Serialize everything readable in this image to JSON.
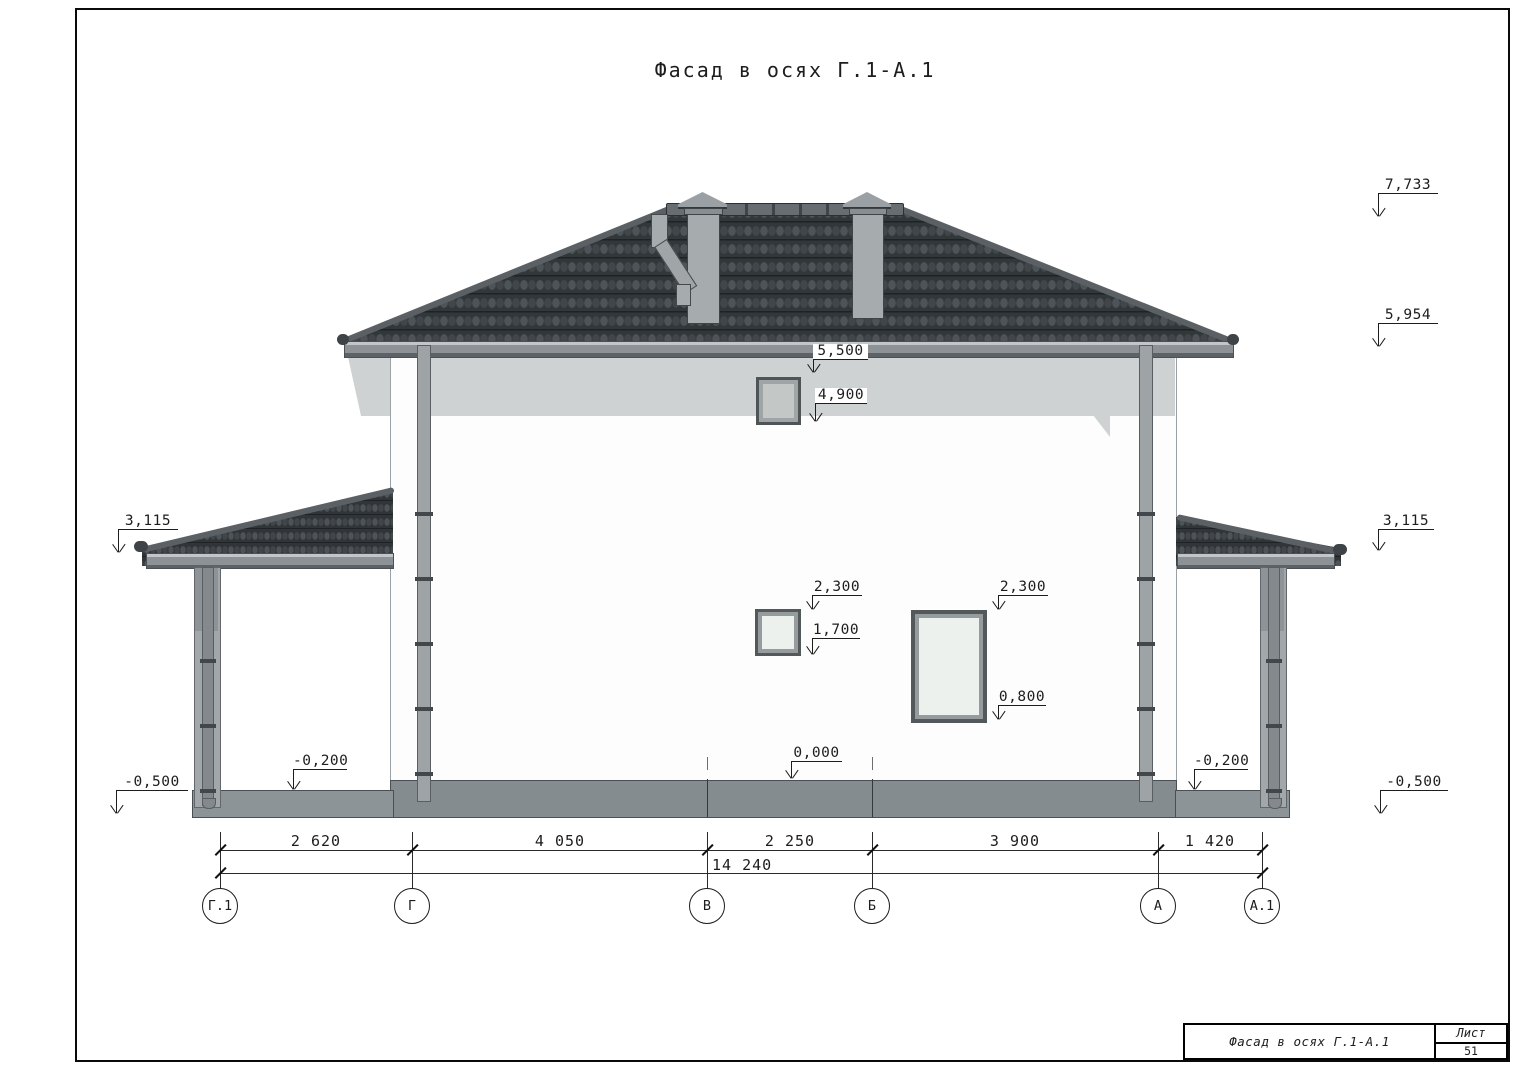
{
  "sheet": {
    "title": "Фасад в осях Г.1-А.1"
  },
  "stamp": {
    "name": "Фасад в осях Г.1-А.1",
    "sheet_label": "Лист",
    "sheet_number": "51"
  },
  "axes": {
    "labels": [
      "Г.1",
      "Г",
      "В",
      "Б",
      "А",
      "А.1"
    ]
  },
  "dims": {
    "segments": [
      "2 620",
      "4 050",
      "2 250",
      "3 900",
      "1 420"
    ],
    "total": "14 240"
  },
  "elevations": {
    "ridge": "7,733",
    "main_eave": "5,954",
    "canopy_left": "3,115",
    "canopy_right": "3,115",
    "ground_left": "-0,500",
    "ground_right": "-0,500",
    "attic_window_head": "5,500",
    "attic_window_sill": "4,900",
    "window1_head": "2,300",
    "window1_sill": "1,700",
    "window2_head": "2,300",
    "window2_sill": "0,800",
    "floor": "0,000",
    "porch_floor_left": "-0,200",
    "porch_floor_right": "-0,200"
  },
  "colors": {
    "roof": "#32373a",
    "metal": "#8d9296",
    "wall_shadow": "#cfd2d2",
    "line": "#1d1d1d"
  }
}
